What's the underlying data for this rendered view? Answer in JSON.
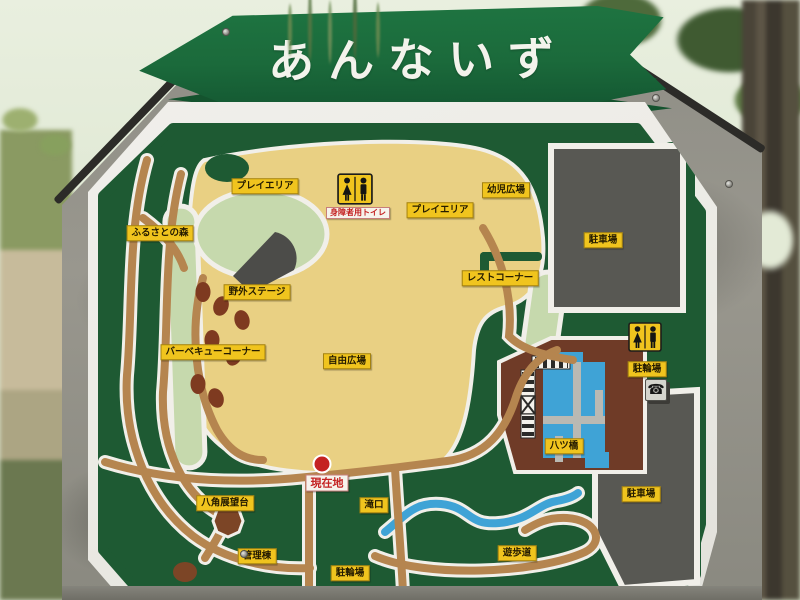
{
  "sign": {
    "title": "あんないず"
  },
  "map": {
    "labels": [
      {
        "text": "プレイエリア",
        "kind": "area"
      },
      {
        "text": "身障者用トイレ",
        "kind": "caption"
      },
      {
        "text": "プレイエリア",
        "kind": "area"
      },
      {
        "text": "幼児広場",
        "kind": "area"
      },
      {
        "text": "ふるさとの森",
        "kind": "area"
      },
      {
        "text": "野外ステージ",
        "kind": "area"
      },
      {
        "text": "レストコーナー",
        "kind": "area"
      },
      {
        "text": "駐車場",
        "kind": "area"
      },
      {
        "text": "バーベキューコーナー",
        "kind": "area"
      },
      {
        "text": "自由広場",
        "kind": "area"
      },
      {
        "text": "駐輪場",
        "kind": "area"
      },
      {
        "text": "八ツ橋",
        "kind": "area"
      },
      {
        "text": "駐車場",
        "kind": "area"
      },
      {
        "text": "現在地",
        "kind": "marker"
      },
      {
        "text": "八角展望台",
        "kind": "area"
      },
      {
        "text": "滝口",
        "kind": "area"
      },
      {
        "text": "管理棟",
        "kind": "area"
      },
      {
        "text": "駐輪場",
        "kind": "area"
      },
      {
        "text": "遊歩道",
        "kind": "area"
      }
    ],
    "icons": {
      "accessible_toilet": "restroom-icon",
      "toilet_right": "restroom-icon",
      "phone": "public-phone-icon",
      "phone_glyph": "☎",
      "current_location_marker": "red-dot"
    }
  },
  "colors": {
    "banner_green": "#1b6a3b",
    "zigzag_green": "#14532e",
    "panel_white": "#ecebe5",
    "map_forest": "#1e5a33",
    "field_cream": "#e9d083",
    "lawn_green": "#c6d9ad",
    "path_tan": "#b5854f",
    "water_blue": "#3fa3d6",
    "parking_gray": "#585853",
    "building_brown": "#6f3b27",
    "label_yellow": "#f0c41e",
    "current_red": "#c42222",
    "stone_gray": "#94938b"
  }
}
